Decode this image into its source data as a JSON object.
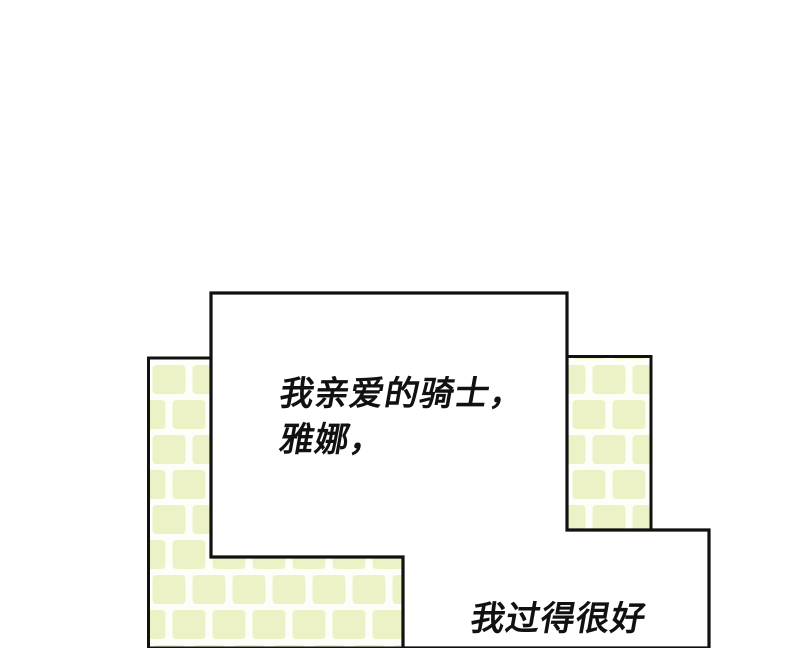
{
  "page": {
    "background_color": "#ffffff",
    "outline_color": "#111111"
  },
  "walls": {
    "brick_color": "#edf2c6",
    "mortar_color": "#fefef9",
    "left_wall": "brick-wall",
    "right_wall": "brick-wall"
  },
  "speech_bubble": {
    "line1": "我亲爱的骑士，",
    "line2": "雅娜，"
  },
  "bottom_panel": {
    "partial_text": "我过得很好"
  }
}
